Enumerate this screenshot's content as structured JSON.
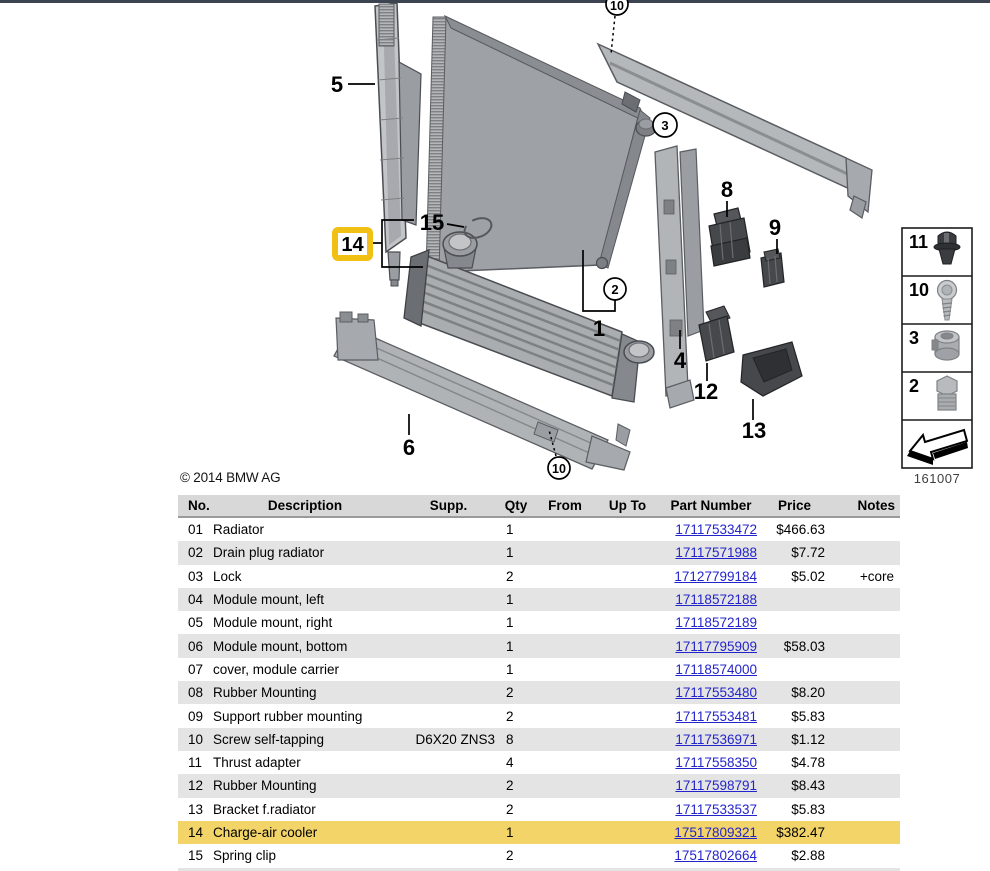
{
  "page": {
    "top_bar_color": "#3d4451"
  },
  "diagram": {
    "copyright": "© 2014 BMW AG",
    "image_code": "161007",
    "highlight_box_color": "#f0c014",
    "callouts": {
      "left_mount": "5",
      "top_screw": "10",
      "lock": "3",
      "rubber_mount_8": "8",
      "support_mount": "9",
      "spring_clip": "15",
      "charge_air_cooler": "14",
      "drain_plug": "2",
      "radiator": "1",
      "right_mount": "4",
      "rubber_mount_12": "12",
      "bracket": "13",
      "bottom_mount": "6",
      "bottom_screw": "10"
    },
    "legend": {
      "items": [
        {
          "number": "11",
          "icon": "rivet-icon"
        },
        {
          "number": "10",
          "icon": "screw-icon"
        },
        {
          "number": "3",
          "icon": "lock-icon"
        },
        {
          "number": "2",
          "icon": "drain-plug-icon"
        },
        {
          "number": "",
          "icon": "direction-arrow-icon"
        }
      ]
    }
  },
  "table": {
    "header_bg": "#d8d8d8",
    "stripe_bg": "#e4e4e4",
    "row_highlight_color": "#f2d469",
    "link_color": "#2424cc",
    "columns": [
      "No.",
      "Description",
      "Supp.",
      "Qty",
      "From",
      "Up To",
      "Part Number",
      "Price",
      "Notes"
    ],
    "rows": [
      {
        "no": "01",
        "description": "Radiator",
        "supp": "",
        "qty": "1",
        "from": "",
        "up_to": "",
        "part_number": "17117533472",
        "price": "$466.63",
        "notes": "",
        "highlighted": false
      },
      {
        "no": "02",
        "description": "Drain plug radiator",
        "supp": "",
        "qty": "1",
        "from": "",
        "up_to": "",
        "part_number": "17117571988",
        "price": "$7.72",
        "notes": "",
        "highlighted": false
      },
      {
        "no": "03",
        "description": "Lock",
        "supp": "",
        "qty": "2",
        "from": "",
        "up_to": "",
        "part_number": "17127799184",
        "price": "$5.02",
        "notes": "+core",
        "highlighted": false
      },
      {
        "no": "04",
        "description": "Module mount, left",
        "supp": "",
        "qty": "1",
        "from": "",
        "up_to": "",
        "part_number": "17118572188",
        "price": "",
        "notes": "",
        "highlighted": false
      },
      {
        "no": "05",
        "description": "Module mount, right",
        "supp": "",
        "qty": "1",
        "from": "",
        "up_to": "",
        "part_number": "17118572189",
        "price": "",
        "notes": "",
        "highlighted": false
      },
      {
        "no": "06",
        "description": "Module mount, bottom",
        "supp": "",
        "qty": "1",
        "from": "",
        "up_to": "",
        "part_number": "17117795909",
        "price": "$58.03",
        "notes": "",
        "highlighted": false
      },
      {
        "no": "07",
        "description": "cover, module carrier",
        "supp": "",
        "qty": "1",
        "from": "",
        "up_to": "",
        "part_number": "17118574000",
        "price": "",
        "notes": "",
        "highlighted": false
      },
      {
        "no": "08",
        "description": "Rubber Mounting",
        "supp": "",
        "qty": "2",
        "from": "",
        "up_to": "",
        "part_number": "17117553480",
        "price": "$8.20",
        "notes": "",
        "highlighted": false
      },
      {
        "no": "09",
        "description": "Support rubber mounting",
        "supp": "",
        "qty": "2",
        "from": "",
        "up_to": "",
        "part_number": "17117553481",
        "price": "$5.83",
        "notes": "",
        "highlighted": false
      },
      {
        "no": "10",
        "description": "Screw self-tapping",
        "supp": "D6X20 ZNS3",
        "qty": "8",
        "from": "",
        "up_to": "",
        "part_number": "17117536971",
        "price": "$1.12",
        "notes": "",
        "highlighted": false
      },
      {
        "no": "11",
        "description": "Thrust adapter",
        "supp": "",
        "qty": "4",
        "from": "",
        "up_to": "",
        "part_number": "17117558350",
        "price": "$4.78",
        "notes": "",
        "highlighted": false
      },
      {
        "no": "12",
        "description": "Rubber Mounting",
        "supp": "",
        "qty": "2",
        "from": "",
        "up_to": "",
        "part_number": "17117598791",
        "price": "$8.43",
        "notes": "",
        "highlighted": false
      },
      {
        "no": "13",
        "description": "Bracket f.radiator",
        "supp": "",
        "qty": "2",
        "from": "",
        "up_to": "",
        "part_number": "17117533537",
        "price": "$5.83",
        "notes": "",
        "highlighted": false
      },
      {
        "no": "14",
        "description": "Charge-air cooler",
        "supp": "",
        "qty": "1",
        "from": "",
        "up_to": "",
        "part_number": "17517809321",
        "price": "$382.47",
        "notes": "",
        "highlighted": true
      },
      {
        "no": "15",
        "description": "Spring clip",
        "supp": "",
        "qty": "2",
        "from": "",
        "up_to": "",
        "part_number": "17517802664",
        "price": "$2.88",
        "notes": "",
        "highlighted": false
      }
    ]
  }
}
